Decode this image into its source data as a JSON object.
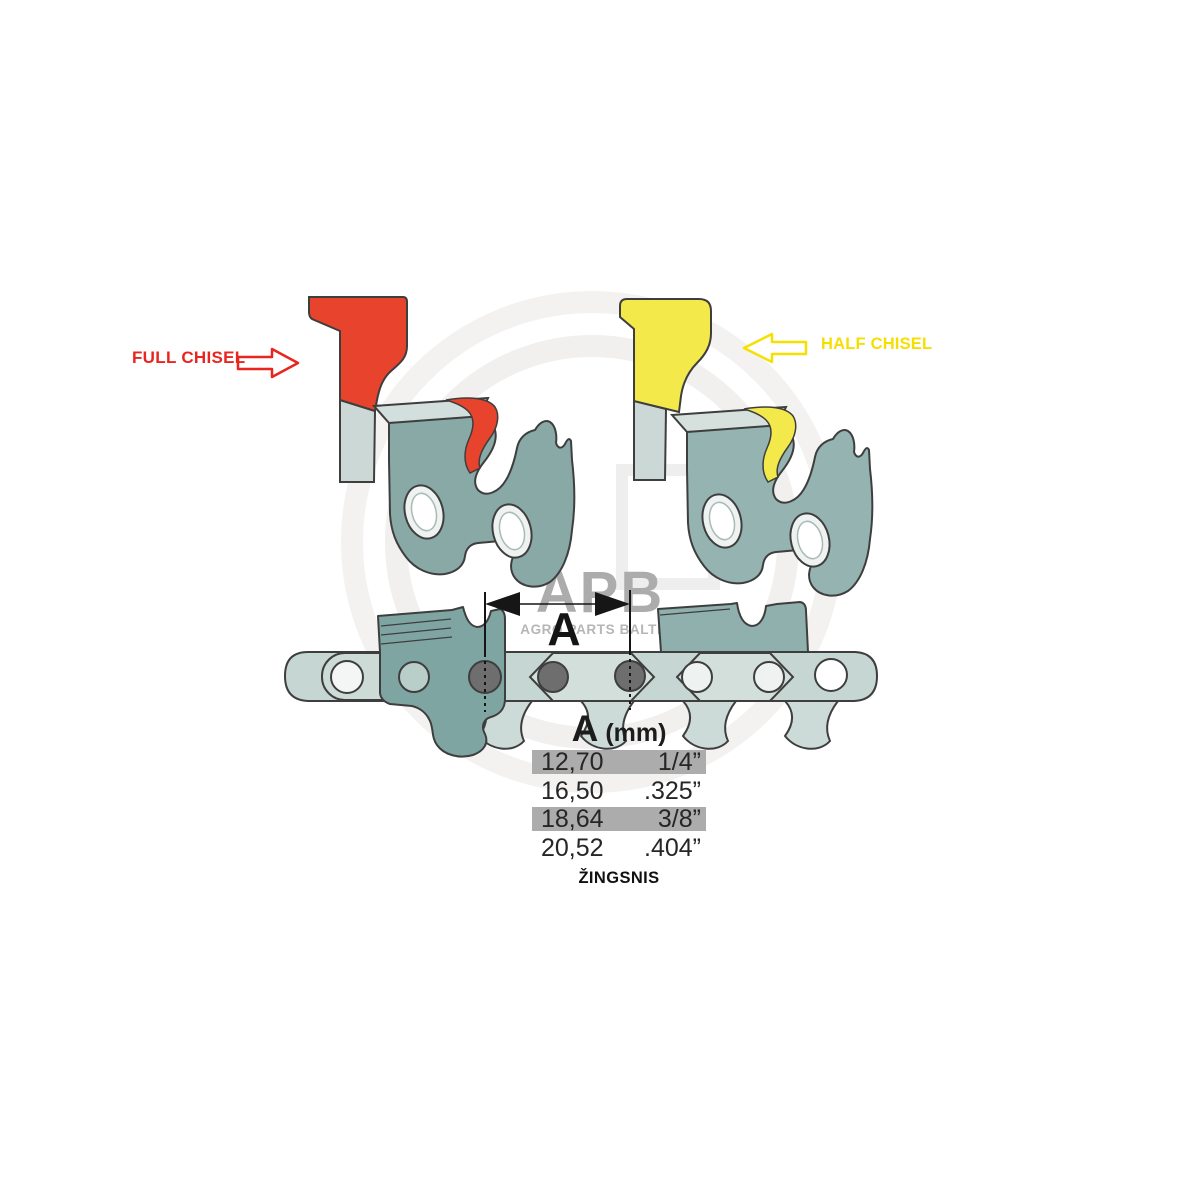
{
  "labels": {
    "full_chisel": "FULL CHISEL",
    "half_chisel": "HALF CHISEL"
  },
  "watermark": {
    "brand": "APB",
    "tagline": "AGRO PARTS BALTIJA"
  },
  "dimension": {
    "symbol": "A"
  },
  "pitch_table": {
    "header": {
      "symbol": "A",
      "unit": "(mm)"
    },
    "rows": [
      {
        "mm": "12,70",
        "inch": "1/4”",
        "highlighted": true
      },
      {
        "mm": "16,50",
        "inch": ".325”",
        "highlighted": false
      },
      {
        "mm": "18,64",
        "inch": "3/8”",
        "highlighted": true
      },
      {
        "mm": "20,52",
        "inch": ".404”",
        "highlighted": false
      }
    ],
    "caption": "ŽINGSNIS"
  },
  "colors": {
    "full_chisel_accent": "#e8432c",
    "half_chisel_accent": "#f3e94b",
    "full_chisel_label": "#e8251f",
    "half_chisel_label": "#f6df00",
    "link_steel_dark": "#7fa5a3",
    "link_steel_light": "#95b4b1",
    "chain_steel": "#c6d7d3",
    "rivet": "#6e6e6e",
    "row_highlight": "#acacac",
    "watermark_gray": "#acacac"
  }
}
